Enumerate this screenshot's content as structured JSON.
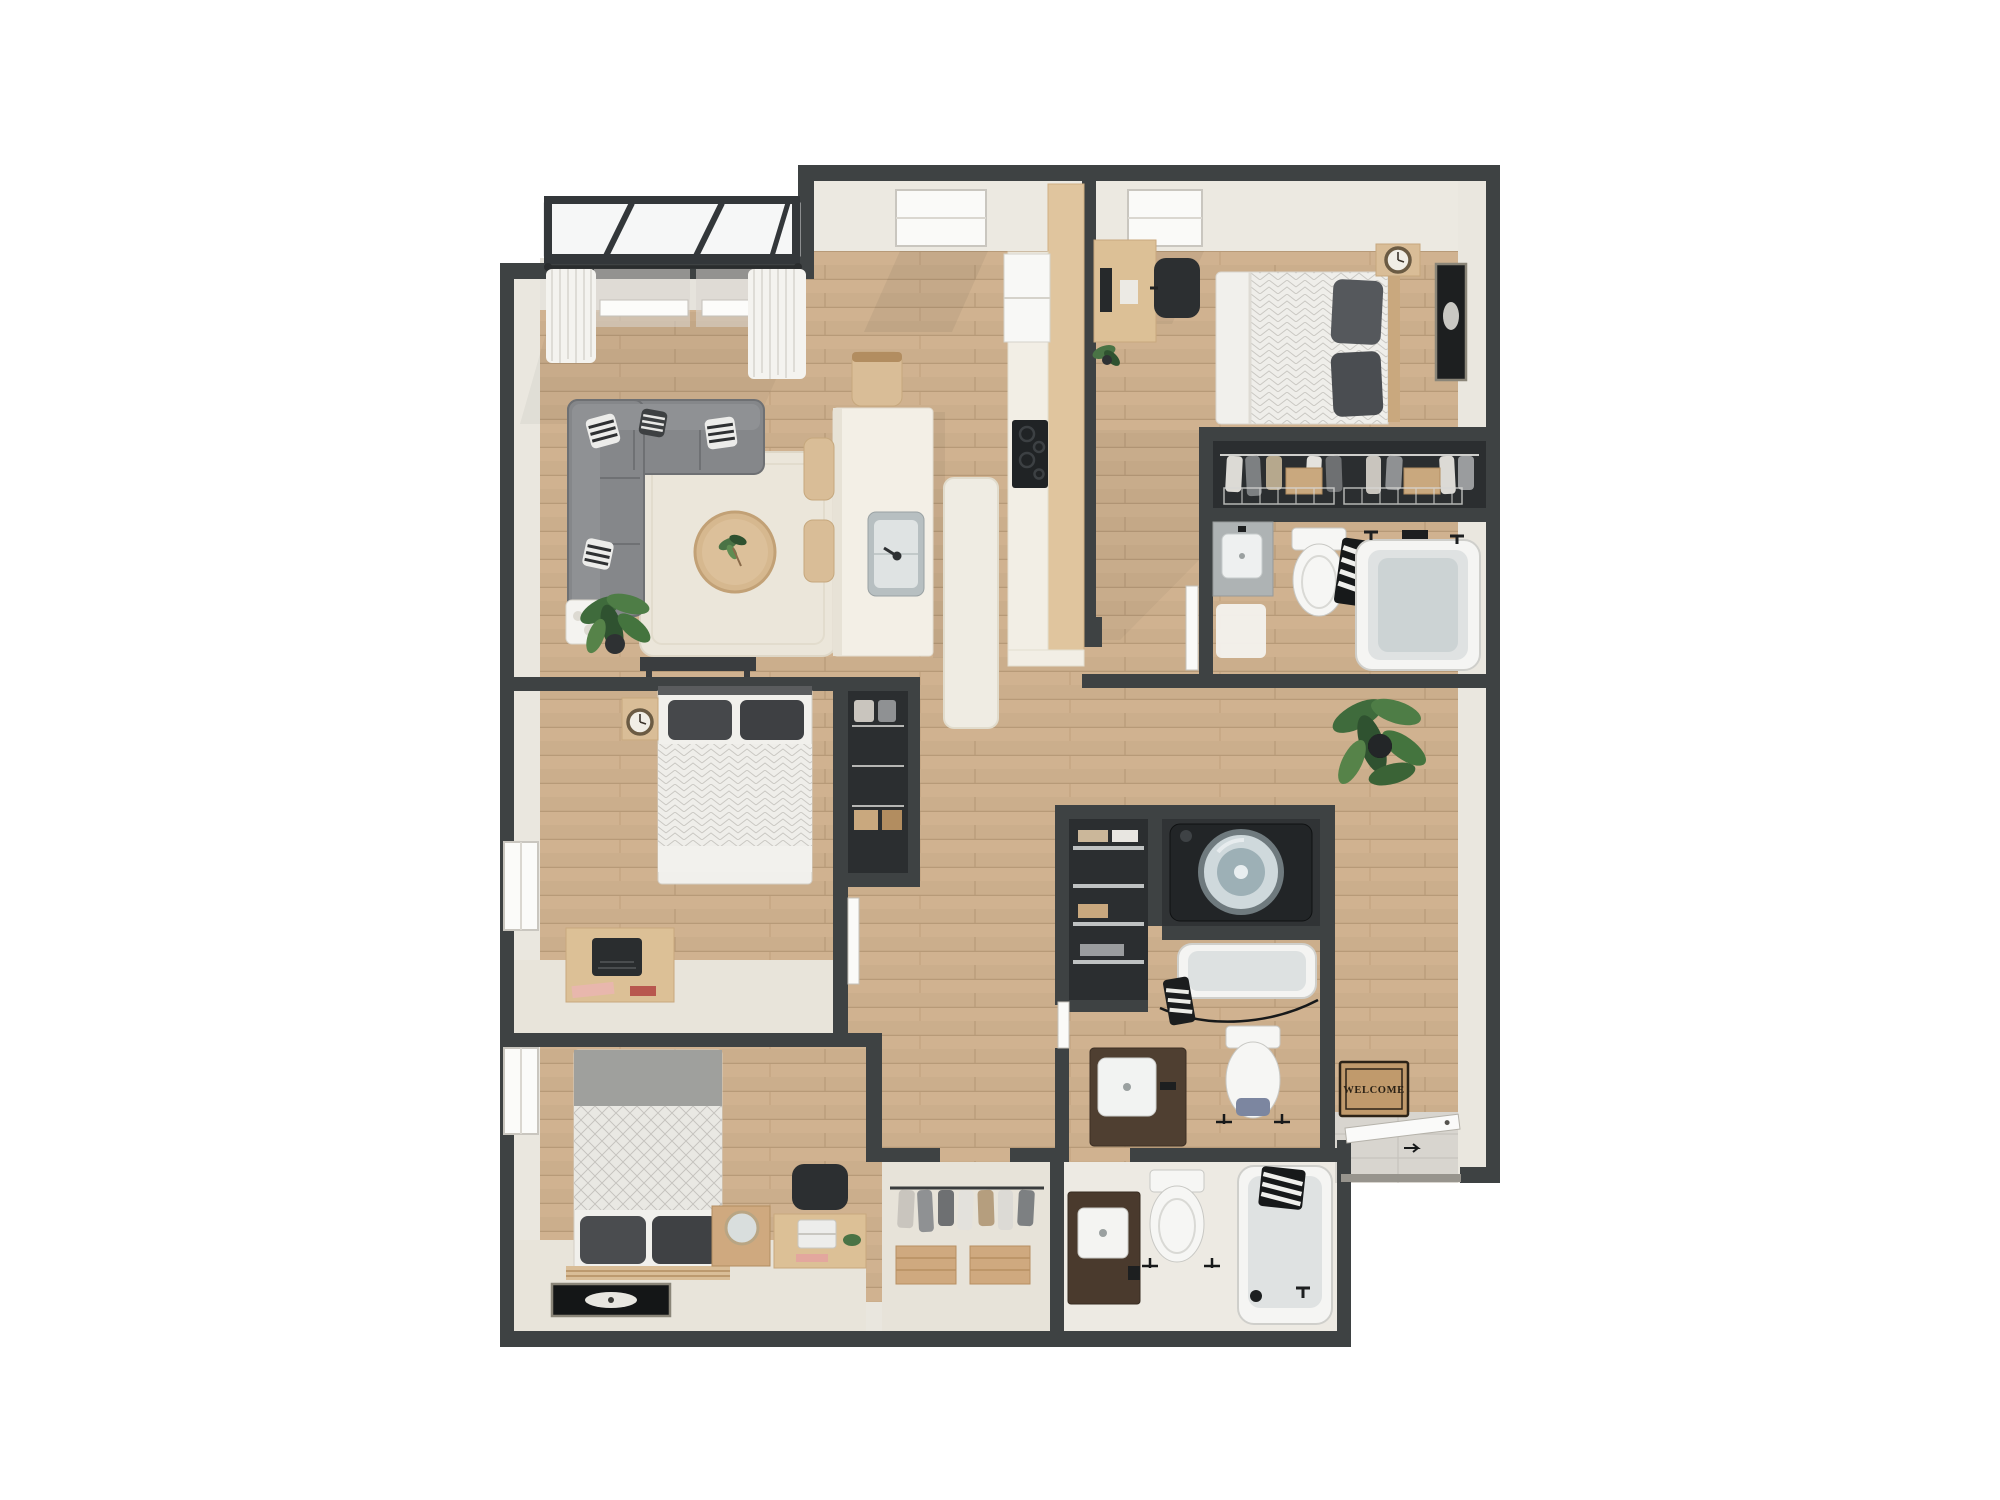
{
  "scene": {
    "description": "3D rendered top-down apartment floor plan on white background",
    "background": "#ffffff"
  },
  "entry": {
    "mat_text": "WELCOME",
    "furniture": [
      "welcome-mat",
      "entry-door",
      "tile-landing"
    ]
  },
  "palette": {
    "wall_dark": "#3e4243",
    "wall_face_cream": "#eae7df",
    "wood_floor": "#cbae8c",
    "wood_plank_line": "#b79a78",
    "carpet_cream": "#e8e4da",
    "counter_white": "#f3efe6",
    "cabinet_wood": "#dcc096",
    "sofa_gray": "#85878a",
    "pillow_dark": "#4a4c4f",
    "fixture_white": "#f6f6f4",
    "tub_inner": "#dfe2e2",
    "closet_dark": "#2b2e30",
    "plant_green": "#4a7345",
    "mat_tan": "#c09a6c",
    "mat_text_color": "#2a2115",
    "glass": "#f6f7f7"
  },
  "rooms": [
    {
      "name": "balcony",
      "furniture": [
        "glass-panels",
        "railing"
      ]
    },
    {
      "name": "living-room",
      "furniture": [
        "sectional-sofa",
        "striped-pillows",
        "round-coffee-table",
        "area-rug",
        "floor-plant",
        "console-table",
        "curtains",
        "windows"
      ]
    },
    {
      "name": "kitchen-dining",
      "furniture": [
        "island-with-sink",
        "bar-chairs",
        "dining-chair",
        "refrigerator",
        "cooktop",
        "tall-wood-cabinet",
        "runner-rug",
        "skylight-window"
      ]
    },
    {
      "name": "bedroom-1",
      "furniture": [
        "double-bed",
        "gray-pillows",
        "desk",
        "monitor",
        "desk-chair",
        "nightstand-with-clock",
        "wall-art",
        "small-plant",
        "skylight-window"
      ]
    },
    {
      "name": "closet-1",
      "furniture": [
        "hanging-clothes",
        "wire-baskets",
        "storage-boxes"
      ]
    },
    {
      "name": "bathroom-1",
      "furniture": [
        "vanity-sink",
        "bath-mat",
        "toilet",
        "bathtub",
        "striped-towel",
        "door"
      ]
    },
    {
      "name": "bedroom-2",
      "furniture": [
        "double-bed",
        "nightstand-with-clock",
        "desk-with-typewriter",
        "window",
        "closet-niche",
        "door"
      ]
    },
    {
      "name": "bedroom-3",
      "furniture": [
        "double-bed",
        "slat-headboard",
        "flower-art-rug",
        "crate-nightstand-with-mirror",
        "desk-with-laptop",
        "desk-chair",
        "window"
      ]
    },
    {
      "name": "laundry",
      "furniture": [
        "washing-machine",
        "wire-shelving",
        "folded-towels"
      ]
    },
    {
      "name": "bathroom-2",
      "furniture": [
        "bathtub",
        "shower-curtain",
        "vanity-sink",
        "toilet",
        "door"
      ]
    },
    {
      "name": "closet-2",
      "furniture": [
        "hanging-clothes",
        "storage-benches"
      ]
    },
    {
      "name": "bathroom-3",
      "furniture": [
        "vanity-sink",
        "toilet",
        "bathtub",
        "striped-towel"
      ]
    },
    {
      "name": "hallway",
      "furniture": [
        "potted-plant"
      ]
    }
  ]
}
